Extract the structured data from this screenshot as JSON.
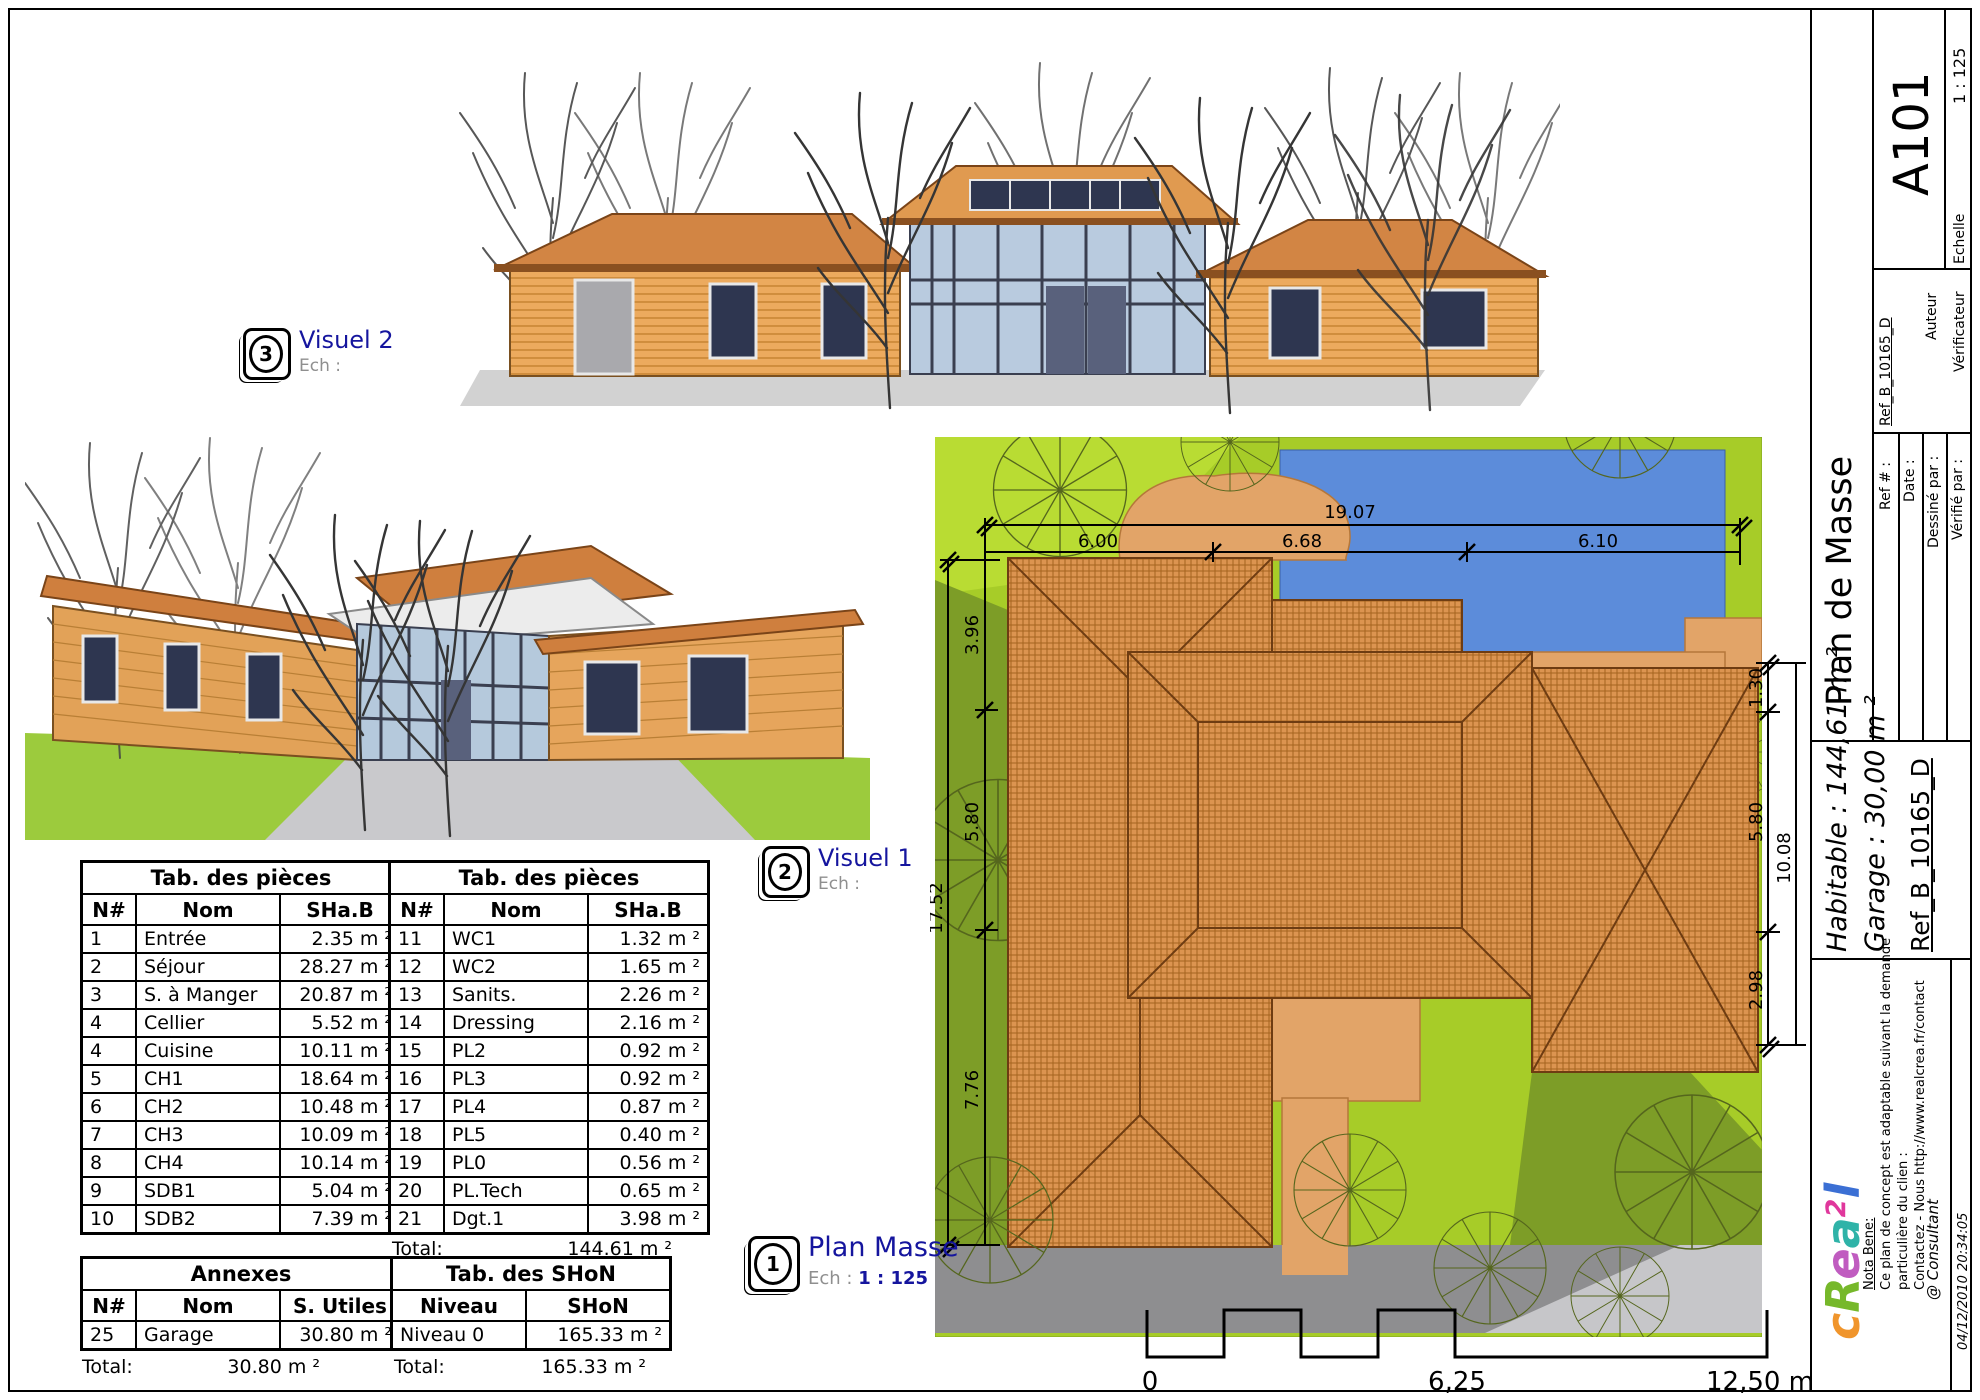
{
  "titleblock": {
    "sheet_code": "A101",
    "scale_value": "1 : 125",
    "scale_label": "Echelle",
    "author_label": "Auteur",
    "verifier_label": "Vérificateur",
    "ref_value": "Ref_B_10165_D",
    "title": "Plan de Masse",
    "fields": {
      "ref": "Ref # :",
      "date": "Date :",
      "drawn": "Dessiné par :",
      "checked": "Vérifié par :"
    },
    "habitable": "Habitable : 144,61 m ²",
    "garage": "Garage : 30,00 m ²",
    "ref_big": "Ref_B_10165_D",
    "nota_bene_title": "Nota Bene:",
    "nota_bene_lines": [
      "Ce plan de concept est adaptable suivant la demande",
      "particulière du clien :",
      "Contactez - Nous http://www.realcrea.fr/contact"
    ],
    "consultant": "@ Consultant",
    "timestamp": "04/12/2010 20:34:05",
    "logo_letters": [
      {
        "ch": "c",
        "color": "#f0952c",
        "sup": false
      },
      {
        "ch": "R",
        "color": "#76b82a",
        "sup": false
      },
      {
        "ch": "e",
        "color": "#c05cc0",
        "sup": false
      },
      {
        "ch": "a",
        "color": "#2fb3a8",
        "sup": false
      },
      {
        "ch": "2",
        "color": "#e0379c",
        "sup": true
      },
      {
        "ch": "l",
        "color": "#3b6fd4",
        "sup": false
      }
    ]
  },
  "views": {
    "visuel2": {
      "num": "3",
      "label": "Visuel 2",
      "ech": "Ech :"
    },
    "visuel1": {
      "num": "2",
      "label": "Visuel 1",
      "ech": "Ech :"
    },
    "plan_masse": {
      "num": "1",
      "label": "Plan Masse",
      "ech": "Ech :",
      "scale": "1 : 125"
    }
  },
  "tables": {
    "pieces1": {
      "title": "Tab. des pièces",
      "headers": [
        "N#",
        "Nom",
        "SHa.B"
      ],
      "rows": [
        [
          "1",
          "Entrée",
          "2.35 m ²"
        ],
        [
          "2",
          "Séjour",
          "28.27 m ²"
        ],
        [
          "3",
          "S. à Manger",
          "20.87 m ²"
        ],
        [
          "4",
          "Cellier",
          "5.52 m ²"
        ],
        [
          "4",
          "Cuisine",
          "10.11 m ²"
        ],
        [
          "5",
          "CH1",
          "18.64 m ²"
        ],
        [
          "6",
          "CH2",
          "10.48 m ²"
        ],
        [
          "7",
          "CH3",
          "10.09 m ²"
        ],
        [
          "8",
          "CH4",
          "10.14 m ²"
        ],
        [
          "9",
          "SDB1",
          "5.04 m ²"
        ],
        [
          "10",
          "SDB2",
          "7.39 m ²"
        ]
      ]
    },
    "pieces2": {
      "title": "Tab. des pièces",
      "headers": [
        "N#",
        "Nom",
        "SHa.B"
      ],
      "rows": [
        [
          "11",
          "WC1",
          "1.32 m ²"
        ],
        [
          "12",
          "WC2",
          "1.65 m ²"
        ],
        [
          "13",
          "Sanits.",
          "2.26 m ²"
        ],
        [
          "14",
          "Dressing",
          "2.16 m ²"
        ],
        [
          "15",
          "PL2",
          "0.92 m ²"
        ],
        [
          "16",
          "PL3",
          "0.92 m ²"
        ],
        [
          "17",
          "PL4",
          "0.87 m ²"
        ],
        [
          "18",
          "PL5",
          "0.40 m ²"
        ],
        [
          "19",
          "PL0",
          "0.56 m ²"
        ],
        [
          "20",
          "PL.Tech",
          "0.65 m ²"
        ],
        [
          "21",
          "Dgt.1",
          "3.98 m ²"
        ]
      ],
      "total_label": "Total:",
      "total_value": "144.61 m ²"
    },
    "annexes": {
      "title": "Annexes",
      "headers": [
        "N#",
        "Nom",
        "S. Utiles"
      ],
      "rows": [
        [
          "25",
          "Garage",
          "30.80 m ²"
        ]
      ],
      "total_label": "Total:",
      "total_value": "30.80 m ²"
    },
    "shon": {
      "title": "Tab. des SHoN",
      "headers": [
        "Niveau",
        "SHoN"
      ],
      "rows": [
        [
          "Niveau 0",
          "165.33 m ²"
        ]
      ],
      "total_label": "Total:",
      "total_value": "165.33 m ²"
    }
  },
  "site_plan": {
    "dims": {
      "top_total": "19.07",
      "top_1": "6.00",
      "top_2": "6.68",
      "top_3": "6.10",
      "left_total": "17.52",
      "left_1": "3.96",
      "left_2": "5.80",
      "left_3": "7.76",
      "right_total": "10.08",
      "right_1": "1.30",
      "right_2": "5.80",
      "right_3": "2.98"
    },
    "colors": {
      "lawn": "#a7cc28",
      "lawn_light": "#b9dc33",
      "lawn_shadow": "#7d9d27",
      "pool": "#5c8cda",
      "path": "#e2a468",
      "roof": "#dc9450",
      "road": "#8e8e90",
      "sidewalk": "#c6c6c9"
    }
  },
  "scale_bar": {
    "start": "0",
    "mid": "6,25",
    "end": "12,50 m"
  }
}
